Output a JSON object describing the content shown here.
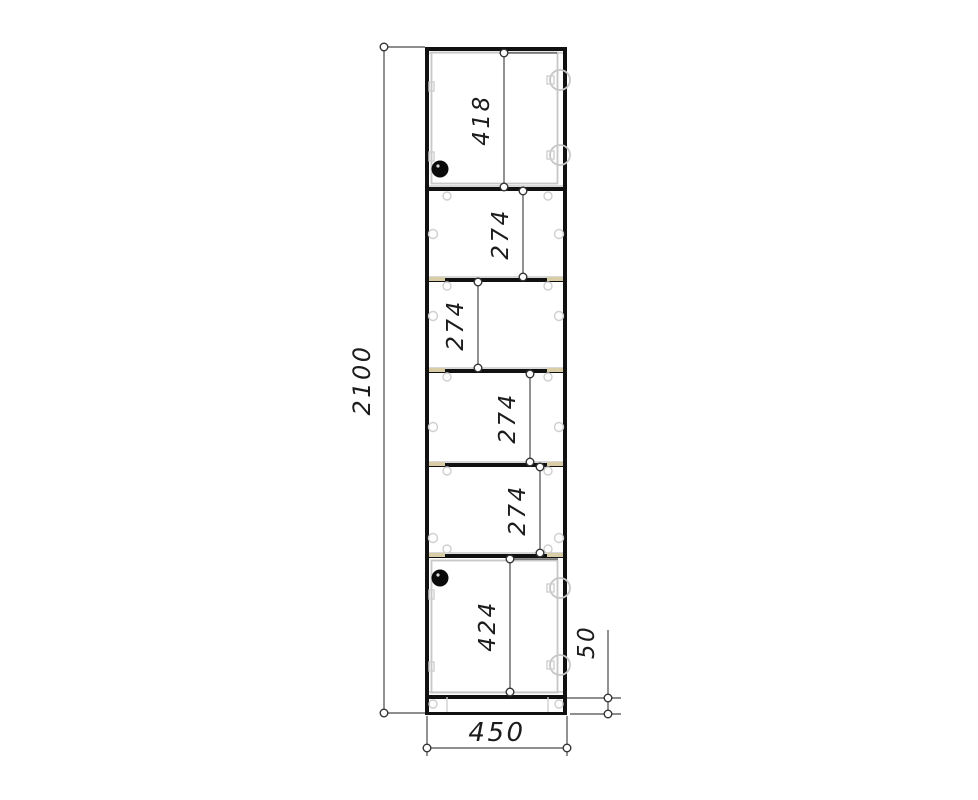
{
  "drawing": {
    "kind": "cabinet-front-dimension-drawing",
    "sections_top_to_bottom": [
      "418",
      "274",
      "274",
      "274",
      "274",
      "424"
    ]
  },
  "dims": {
    "height": {
      "label": "2100"
    },
    "width": {
      "label": "450"
    },
    "plinth": {
      "label": "50"
    },
    "top_section": {
      "label": "418"
    },
    "middle_sections": [
      {
        "label": "274"
      },
      {
        "label": "274"
      },
      {
        "label": "274"
      },
      {
        "label": "274"
      }
    ],
    "bottom_section": {
      "label": "424"
    }
  },
  "colors": {
    "line": "#111111",
    "dimension": "#4a4a4a",
    "hardware": "#c6c6c6",
    "shelf_support": "#d8cda6",
    "handle": "#0a0a0a",
    "background": "#ffffff"
  }
}
